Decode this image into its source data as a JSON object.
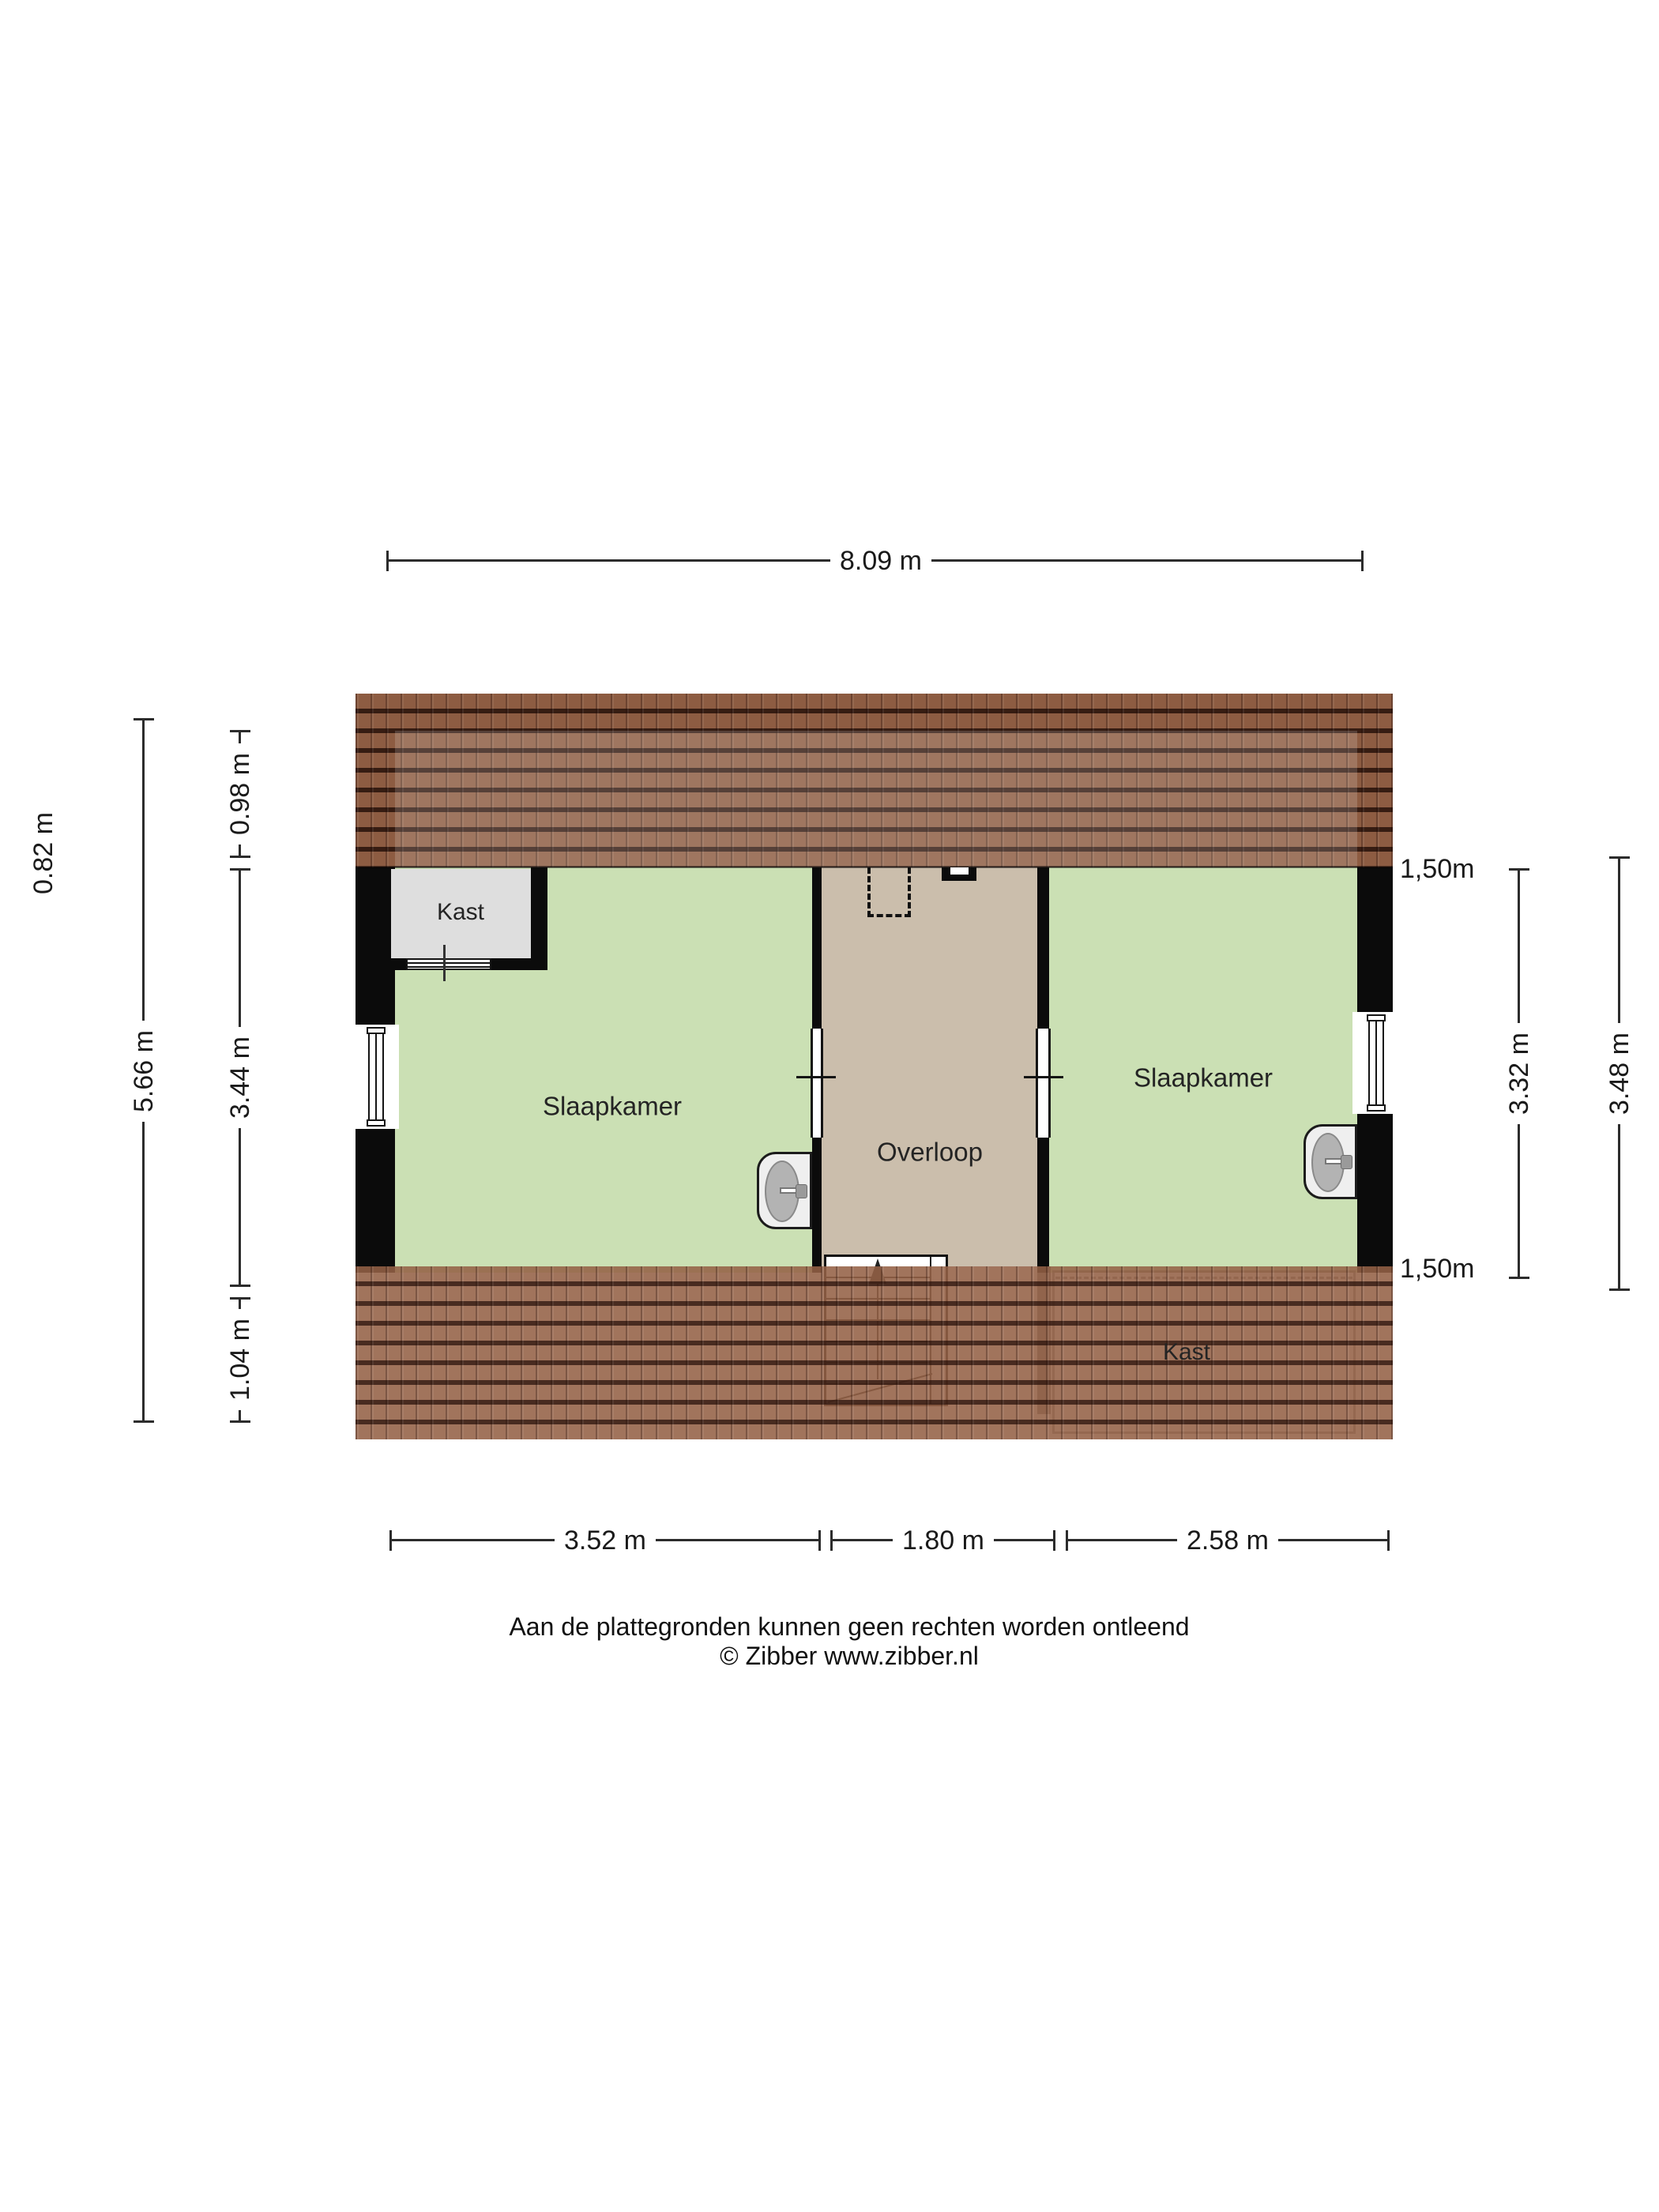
{
  "dimensions": {
    "top_width": "8.09 m",
    "left_outer": "0.82 m",
    "left_total": "5.66 m",
    "left_top": "0.98 m",
    "left_mid": "3.44 m",
    "left_bottom": "1.04 m",
    "right_mark_top": "1,50m",
    "right_mark_bottom": "1,50m",
    "right_inner": "3.32 m",
    "right_outer": "3.48 m",
    "bottom_left": "3.52 m",
    "bottom_mid": "1.80 m",
    "bottom_right": "2.58 m"
  },
  "rooms": {
    "bedroom_left": "Slaapkamer",
    "bedroom_right": "Slaapkamer",
    "landing": "Overloop",
    "closet_top_left": "Kast",
    "closet_bottom_right": "Kast"
  },
  "footer": {
    "disclaimer": "Aan de plattegronden kunnen geen rechten worden ontleend",
    "credit": "© Zibber www.zibber.nl"
  },
  "colors": {
    "bedroom_fill": "#cbe0b4",
    "landing_fill": "#cbbeac",
    "closet_fill": "#dedede",
    "roof_tile": "#8d5c42",
    "wall": "#0b0b0b"
  }
}
